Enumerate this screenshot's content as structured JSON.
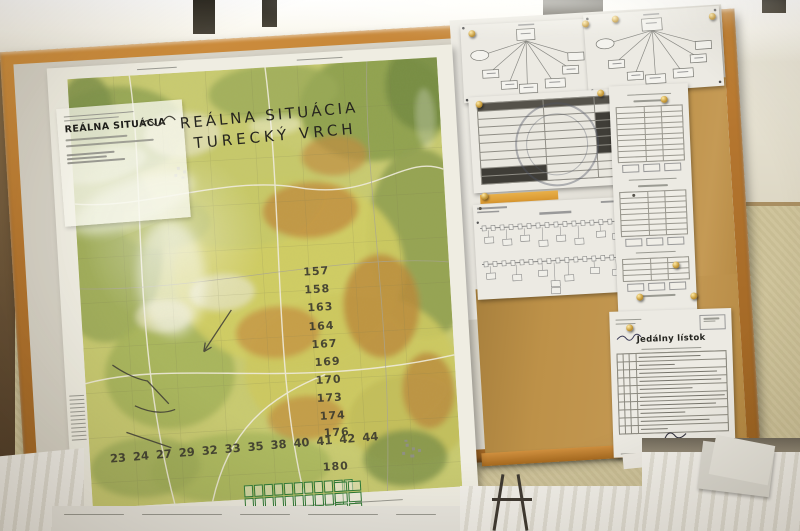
{
  "board": {
    "frame_color": "#b5762f",
    "kraft_paper_color": "#bf9450",
    "backing_color": "#e3e1d9"
  },
  "map": {
    "info_card_heading": "REÁLNA SITUÁCIA",
    "handwritten_title": [
      "REÁLNA SITUÁCIA",
      "TURECKÝ VRCH"
    ],
    "numbers_column": [
      "157",
      "158",
      "163",
      "164",
      "167",
      "169",
      "170",
      "173",
      "174",
      "176",
      "180"
    ],
    "numbers_row": [
      "23",
      "24",
      "27",
      "29",
      "32",
      "33",
      "35",
      "38",
      "40",
      "41",
      "42",
      "44"
    ],
    "base_color": "#c9cb70",
    "forest_color": "#97a854",
    "field_color": "#d0cd62",
    "clearing_color": "#c28d3c"
  },
  "documents": {
    "menu_title": "Jedálny lístok"
  },
  "pins": {
    "color": "#c79b3a"
  }
}
